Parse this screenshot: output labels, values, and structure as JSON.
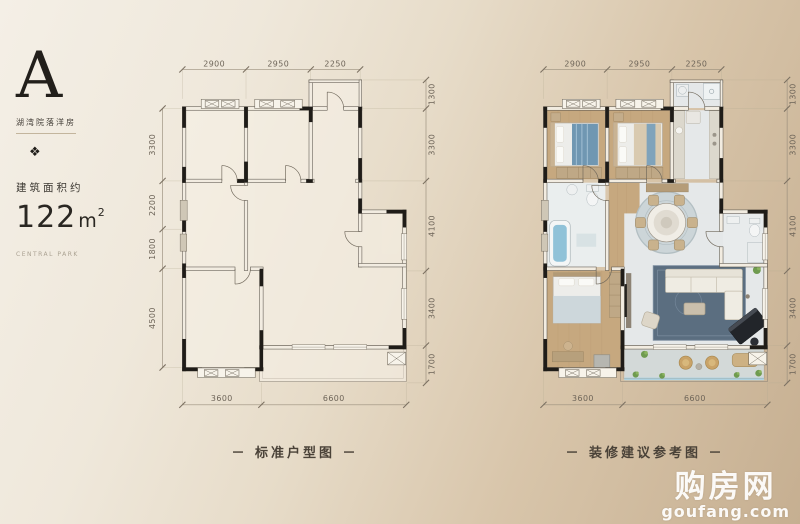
{
  "panel": {
    "type_letter": "A",
    "type_subtitle": "湖湾院落洋房",
    "ornament": "❖",
    "area_label": "建筑面积约",
    "area_number": "122",
    "area_unit": "m",
    "area_exponent": "2",
    "brand_text": "CENTRAL PARK"
  },
  "dims": {
    "top": [
      "2900",
      "2950",
      "2250"
    ],
    "left": [
      "3300",
      "2200",
      "1800",
      "4500"
    ],
    "right": [
      "1300",
      "3300",
      "4100",
      "3400",
      "1700"
    ],
    "bottom": [
      "3600",
      "6600"
    ]
  },
  "plans": {
    "left": {
      "caption": "－ 标准户型图 －"
    },
    "right": {
      "caption": "－ 装修建议参考图 －"
    }
  },
  "watermark": {
    "site_cn": "购房网",
    "site_en": "goufang.com"
  },
  "colors": {
    "wall": "#1f1c18",
    "wood_floor": "#c6a87f",
    "marble_floor": "#e5e8e9",
    "window_glass": "#a9d2e3",
    "living_rug": "#5b6e80",
    "plant_green": "#6f9b4f",
    "background_light": "#f4efe6",
    "background_dark": "#c6af91",
    "dim_text": "#6d6458",
    "caption_text": "#4a4238"
  }
}
